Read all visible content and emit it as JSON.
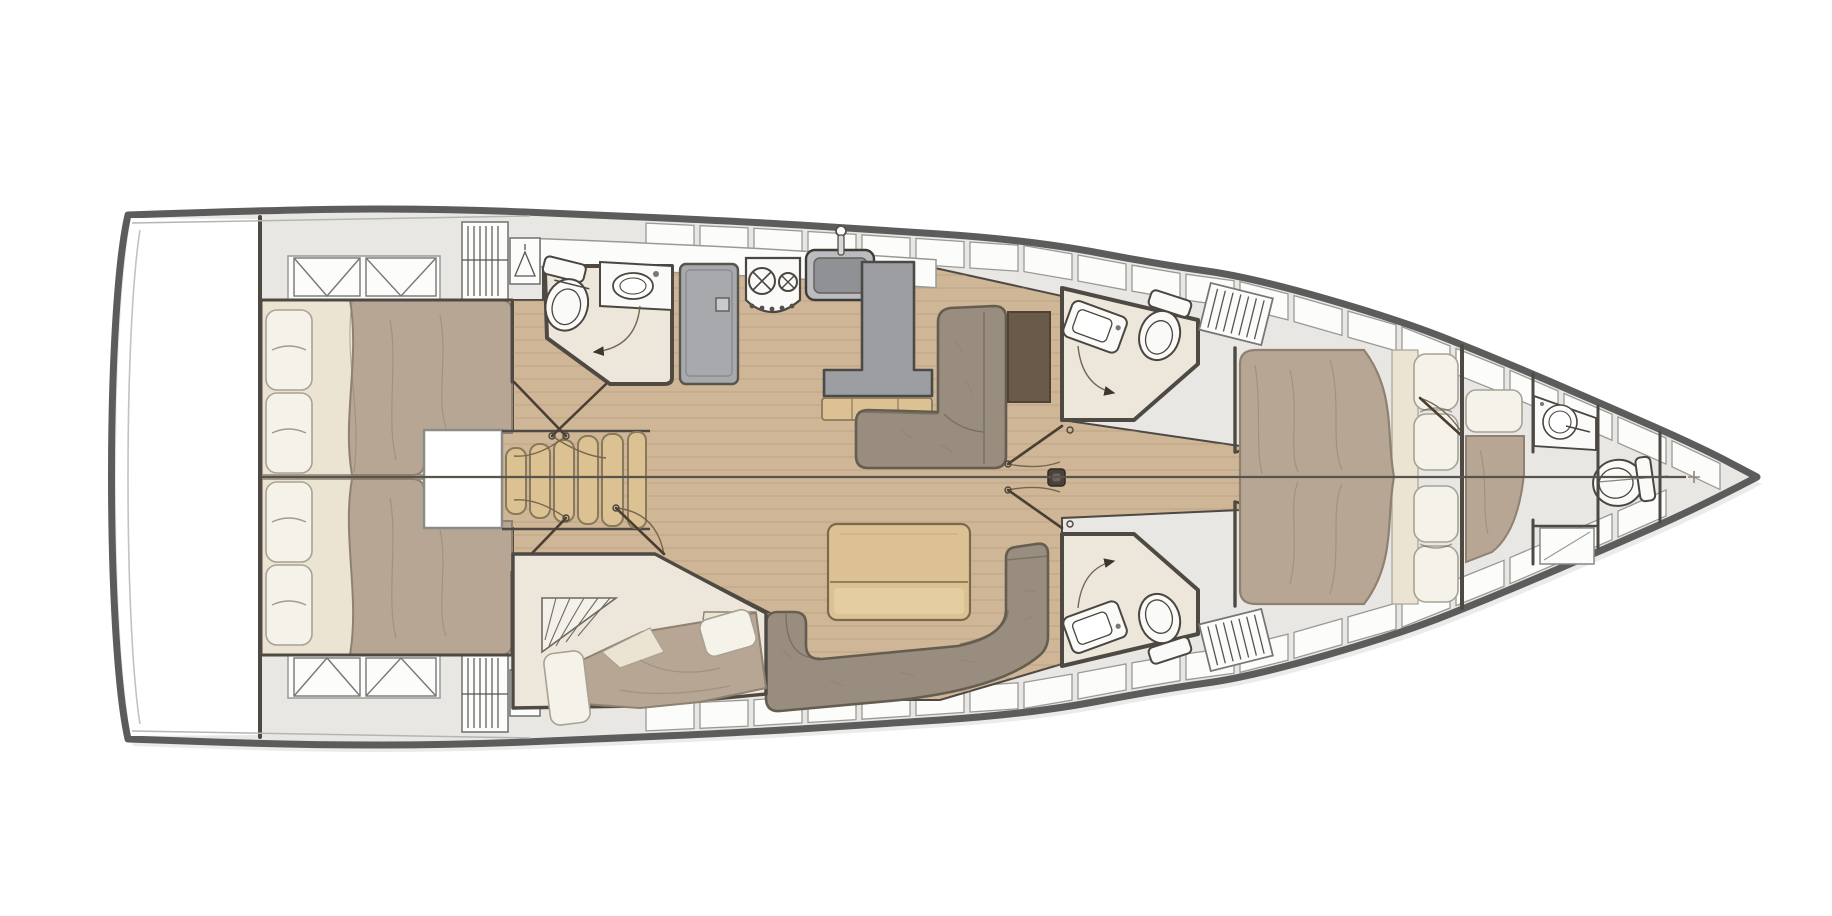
{
  "diagram": {
    "title": "Sailing yacht interior layout plan — bow right, stern left",
    "type": "boat-floor-plan",
    "orientation": {
      "bow": "right",
      "stern": "left",
      "port_side": "top",
      "starboard_side": "bottom"
    },
    "areas": [
      {
        "name": "swim-platform-transom",
        "fixtures": [
          "transom locker"
        ]
      },
      {
        "name": "aft-cabin-port",
        "fixtures": [
          "double berth",
          "2 pillows",
          "2 hatch lockers",
          "wardrobe",
          "hanging locker"
        ]
      },
      {
        "name": "aft-cabin-starboard",
        "fixtures": [
          "double berth",
          "2 pillows",
          "2 hatch lockers",
          "wardrobe",
          "hanging locker"
        ]
      },
      {
        "name": "aft-head-port",
        "fixtures": [
          "toilet",
          "washbasin vanity",
          "door with swing arc"
        ]
      },
      {
        "name": "galley",
        "fixtures": [
          "refrigerator",
          "two-burner stove",
          "sink with faucet",
          "L-shaped worktop",
          "overhead lockers"
        ]
      },
      {
        "name": "companionway",
        "fixtures": [
          "five-step stairs",
          "engine hatch"
        ]
      },
      {
        "name": "salon-port",
        "fixtures": [
          "L-shaped settee",
          "dark side table",
          "chart table"
        ]
      },
      {
        "name": "salon-starboard",
        "fixtures": [
          "U-shaped settee",
          "folding dining table"
        ]
      },
      {
        "name": "mid-cabin-starboard",
        "fixtures": [
          "double berth",
          "2 pillows",
          "under-stair wedge"
        ]
      },
      {
        "name": "forward-head-port",
        "fixtures": [
          "toilet",
          "washbasin vanity",
          "door with swing arc",
          "louvered hatch"
        ]
      },
      {
        "name": "forward-head-starboard",
        "fixtures": [
          "toilet",
          "washbasin vanity",
          "door with swing arc",
          "louvered hatch"
        ]
      },
      {
        "name": "owners-cabin-forward",
        "fixtures": [
          "island double berth",
          "4 pillows",
          "double entry doors"
        ]
      },
      {
        "name": "bow-cabin",
        "fixtures": [
          "single berth",
          "pillow",
          "washbasin"
        ]
      },
      {
        "name": "bow-head",
        "fixtures": [
          "toilet"
        ]
      },
      {
        "name": "forepeak",
        "fixtures": [
          "sail locker"
        ]
      },
      {
        "name": "mast-post",
        "fixtures": [
          "mast step"
        ]
      }
    ],
    "colors": {
      "background": "#ffffff",
      "hull_outline": "#5c5c5c",
      "deck": "#e8e7e3",
      "locker_fill": "#fcfcfb",
      "locker_stroke": "#9a9a95",
      "wall": "#4e4a43",
      "floor_wood": "#cfb697",
      "floor_plank": "#a98f71",
      "wood_light": "#dcc193",
      "wood_trim": "#8a7a5c",
      "blanket": "#b7a694",
      "blanket_edge": "#8f8170",
      "sheet": "#ece4d2",
      "pillow": "#f5f2ea",
      "pillow_stroke": "#a8a295",
      "sofa": "#988d7f",
      "sofa_edge": "#655d50",
      "side_table_brown": "#6a5a4a",
      "counter": "#9d9ea1",
      "appliance": "#fafaf8",
      "fixture_stroke": "#4b463f",
      "head_floor": "#ede7db",
      "sink_basin": "#8f9194",
      "sink_rim": "#babcbf",
      "door": "#4a3f33",
      "swing_arc": "#77664f",
      "arrow": "#3e362c",
      "centerline": "#57534d"
    }
  }
}
